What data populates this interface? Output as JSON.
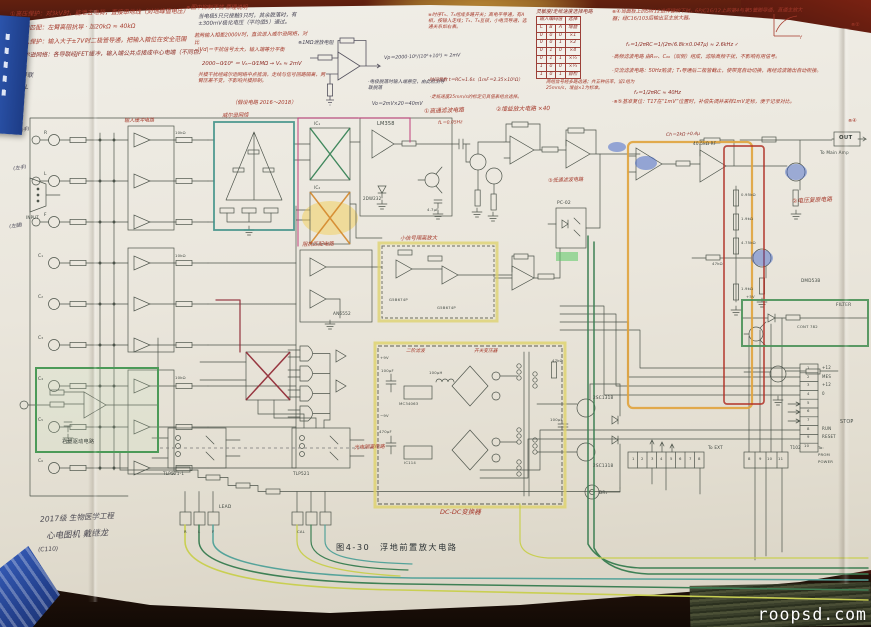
{
  "watermark": "roopsd.com",
  "caption": "图4-30　浮地前置放大电路",
  "bottom_note": {
    "l1": "2017级 生物医学工程",
    "l2": "心电图机  戴继龙",
    "l3": "(C110)"
  },
  "colors": {
    "highlight_teal": "#3f9188",
    "highlight_yellow": "#ded26a",
    "highlight_green": "#4c9a58",
    "highlight_orange": "#e0a33c",
    "highlight_crimson": "#b03127",
    "ink_red": "#a63a2c",
    "wire_green": "#3e8055",
    "wire_yellow": "#c9cf52",
    "wire_teal": "#55a39a",
    "wire_magenta": "#c2447e"
  },
  "truth_table": {
    "title": "灵敏度/走纸速度选择电路",
    "group": [
      "输入编码值",
      "选择"
    ],
    "cols": [
      "C",
      "B",
      "A",
      "增益"
    ],
    "rows": [
      [
        "0",
        "0",
        "0",
        "×1"
      ],
      [
        "0",
        "0",
        "1",
        "×2"
      ],
      [
        "0",
        "1",
        "0",
        "×4"
      ],
      [
        "0",
        "1",
        "1",
        "×½"
      ],
      [
        "1",
        "0",
        "0",
        "×¼"
      ],
      [
        "1",
        "0",
        "1",
        "自检"
      ]
    ]
  },
  "annotations": [
    {
      "t": "①高压保护：对3kV时，能泄去电荷，直接串地线（对地峰值电压）",
      "x": 10,
      "y": 11,
      "c": "red",
      "s": 6,
      "r": -1
    },
    {
      "t": "②高频匹配：左臂高阻抗导 · 加20kΩ ≈ 40kΩ",
      "x": 12,
      "y": 25,
      "c": "red",
      "s": 6,
      "r": -1
    },
    {
      "t": "③输入保护：输入大于±7V时二极管导通，把输入箝位在安全范围",
      "x": 12,
      "y": 39,
      "c": "red",
      "s": 6,
      "r": -1
    },
    {
      "t": "④威尔逊网络：各导联经JFET缓冲，输入端公共点接成中心电端（不同色）",
      "x": 13,
      "y": 53,
      "c": "dred",
      "s": 5.8,
      "r": -1
    },
    {
      "t": "⑤ 3导联",
      "x": 10,
      "y": 72,
      "c": "ink",
      "s": 6
    },
    {
      "t": "⑥ aVL",
      "x": 10,
      "y": 84,
      "c": "ink",
      "s": 6
    },
    {
      "t": "⑦ V₁",
      "x": 10,
      "y": 96,
      "c": "ink",
      "s": 6
    },
    {
      "t": "⑧ V₆",
      "x": 10,
      "y": 107,
      "c": "ink",
      "s": 6
    },
    {
      "t": "※图中抑制干扰 原理说明",
      "x": 186,
      "y": 5,
      "c": "red",
      "s": 5.5
    },
    {
      "t": "当电极5只只接触3只时，其余脱落时，有±300mV极化电压（平均值5）通过。",
      "x": 198,
      "y": 14,
      "c": "ink",
      "s": 5.4,
      "w": 118,
      "r": -1
    },
    {
      "t": "※1MΩ泄放电阻",
      "x": 298,
      "y": 40,
      "c": "ink",
      "s": 5
    },
    {
      "t": "Vp＝2000·10⁶/(10⁶+10⁹) ≈ 2mV",
      "x": 384,
      "y": 56,
      "c": "ink",
      "s": 4.8,
      "r": -2
    },
    {
      "t": "·电极脱落时输入端悬空，由此检测导联脱落",
      "x": 368,
      "y": 80,
      "c": "ink",
      "s": 4.7,
      "w": 80
    },
    {
      "t": "Vo＝2mV×20＝40mV",
      "x": 372,
      "y": 102,
      "c": "ink",
      "s": 4.8
    },
    {
      "t": "若两输入相差2000V时，直流进入威尔逊网络，对比",
      "x": 194,
      "y": 33,
      "c": "red",
      "s": 5.1,
      "w": 116,
      "r": -1
    },
    {
      "t": "|Vd|＝干扰信号太大，输入端等分平衡",
      "x": 198,
      "y": 47,
      "c": "red",
      "s": 5.1,
      "w": 112
    },
    {
      "t": "2000−0⁄10⁶ ＝ V₆−0⁄1MΩ → V₆ ≈ 2mV",
      "x": 202,
      "y": 61,
      "c": "dred",
      "s": 5.3
    },
    {
      "t": "共模干扰经威尔逊网络中点抵消，走线与信号回路隔离，两臂压差不变，不影响共模抑制。",
      "x": 198,
      "y": 72,
      "c": "red",
      "s": 4.9,
      "w": 128
    },
    {
      "t": "（假设电路 2016～2018）",
      "x": 232,
      "y": 100,
      "c": "red",
      "s": 5.2
    },
    {
      "t": "※时序T₅、T₆组成多路开关；高电平导通，有A相，按输入走线；T₅、T₆互锁，小电流导通，选通关系如右表。",
      "x": 428,
      "y": 13,
      "c": "red",
      "s": 4.7,
      "w": 100
    },
    {
      "t": "·时间常数 t＝RC≈1.6s（1mF＝2.35×10⁵Ω）",
      "x": 428,
      "y": 78,
      "c": "dred",
      "s": 4.5,
      "w": 110
    },
    {
      "t": "·走纸速度25mm/s的标定见真值表组合选择。",
      "x": 430,
      "y": 95,
      "c": "red",
      "s": 4.5,
      "w": 110
    },
    {
      "t": "两组信号经多路选通；共五种倍率，设1组为25mm/s，增益×1为标准。",
      "x": 546,
      "y": 80,
      "c": "red",
      "s": 4.5,
      "w": 94
    },
    {
      "t": "※④当面板上的SW12选择键按下时，6P/C16/12上的第4与第5管脚导通，直通主放大器；经C16/103后输出至主放大器。",
      "x": 612,
      "y": 9,
      "c": "red",
      "s": 5,
      "w": 200,
      "r": -0.5
    },
    {
      "t": "f₁＝1/2πRC＝1/(2π√6.8k×0.047μ) ≈ 2.6kHz ✓",
      "x": 626,
      "y": 42,
      "c": "dred",
      "s": 5
    },
    {
      "t": "·高频滤波电路 由R₀₇、C₀₆（双侧）组成，滤除高频干扰，不影响有用信号。",
      "x": 612,
      "y": 54,
      "c": "red",
      "s": 5,
      "w": 206
    },
    {
      "t": "·交流滤波电路：50Hz陷波；T₁导通后二极管截止，使带宽自动切换，再经滤波输出自动衔接。",
      "x": 612,
      "y": 68,
      "c": "red",
      "s": 5,
      "w": 210
    },
    {
      "t": "f₂＝1/2πRC ≈ 40Hz",
      "x": 634,
      "y": 90,
      "c": "dred",
      "s": 5
    },
    {
      "t": "·※⑤基准复位：T17在“1mV”位置时，补偿失调并采样1mV定标，便于记录对比。",
      "x": 612,
      "y": 99,
      "c": "red",
      "s": 5,
      "w": 212
    },
    {
      "t": "f",
      "x": 800,
      "y": 36,
      "c": "red",
      "s": 4.5
    },
    {
      "t": "※②",
      "x": 851,
      "y": 22,
      "c": "red",
      "s": 5
    },
    {
      "t": "※④",
      "x": 848,
      "y": 118,
      "c": "red",
      "s": 5
    },
    {
      "t": "①高通滤波电路",
      "x": 424,
      "y": 109,
      "c": "red",
      "s": 5.8,
      "r": -2
    },
    {
      "t": "fL＝0.05Hz",
      "x": 438,
      "y": 121,
      "c": "red",
      "s": 4.5,
      "r": -2
    },
    {
      "t": "②增益放大电路 ×40",
      "x": 496,
      "y": 107,
      "c": "red",
      "s": 5.8,
      "r": -1
    },
    {
      "t": "③低通滤波电路",
      "x": 548,
      "y": 178,
      "c": "red",
      "s": 5.1,
      "r": -2
    },
    {
      "t": "阻抗匹配电路",
      "x": 302,
      "y": 242,
      "c": "red",
      "s": 5.3,
      "r": -1
    },
    {
      "t": "小信号隔离放大",
      "x": 400,
      "y": 236,
      "c": "red",
      "s": 5.3,
      "r": -1
    },
    {
      "t": "光电隔离电路",
      "x": 354,
      "y": 445,
      "c": "red",
      "s": 5.1,
      "r": -2
    },
    {
      "t": "DC-DC变换器",
      "x": 440,
      "y": 508,
      "c": "red",
      "s": 6.5
    },
    {
      "t": "二阶滤波",
      "x": 406,
      "y": 349,
      "c": "red",
      "s": 4.7
    },
    {
      "t": "开关变压器",
      "x": 474,
      "y": 349,
      "c": "red",
      "s": 4.7
    },
    {
      "t": "②电压复原电路",
      "x": 792,
      "y": 199,
      "c": "red",
      "s": 5.8,
      "r": -3
    },
    {
      "t": "Ch＝2kΩ＋0.4μ",
      "x": 666,
      "y": 133,
      "c": "dred",
      "s": 4.5,
      "r": -2
    },
    {
      "t": "威尔逊网络",
      "x": 222,
      "y": 113,
      "c": "red",
      "s": 5.3,
      "r": -1
    },
    {
      "t": "输入缓冲电路",
      "x": 124,
      "y": 118,
      "c": "red",
      "s": 5,
      "r": -1
    },
    {
      "t": "(右手)",
      "x": 16,
      "y": 129,
      "c": "ink",
      "s": 4.8,
      "r": -8
    },
    {
      "t": "(左手)",
      "x": 13,
      "y": 167,
      "c": "ink",
      "s": 4.8,
      "r": -8
    },
    {
      "t": "(左腿)",
      "x": 9,
      "y": 225,
      "c": "ink",
      "s": 4.8,
      "r": -8
    },
    {
      "t": "R",
      "x": 44,
      "y": 131,
      "c": "prt",
      "s": 4.4
    },
    {
      "t": "L",
      "x": 44,
      "y": 172,
      "c": "prt",
      "s": 4.4
    },
    {
      "t": "F",
      "x": 44,
      "y": 213,
      "c": "prt",
      "s": 4.4
    },
    {
      "t": "C₁",
      "x": 38,
      "y": 254,
      "c": "prt",
      "s": 4.4
    },
    {
      "t": "C₂",
      "x": 38,
      "y": 295,
      "c": "prt",
      "s": 4.4
    },
    {
      "t": "C₃",
      "x": 38,
      "y": 336,
      "c": "prt",
      "s": 4.4
    },
    {
      "t": "C₄",
      "x": 38,
      "y": 377,
      "c": "prt",
      "s": 4.4
    },
    {
      "t": "C₅",
      "x": 38,
      "y": 418,
      "c": "prt",
      "s": 4.4
    },
    {
      "t": "C₆",
      "x": 38,
      "y": 459,
      "c": "prt",
      "s": 4.4
    },
    {
      "t": "INPUT",
      "x": 26,
      "y": 215,
      "c": "prt",
      "s": 4
    },
    {
      "t": "10kΩ",
      "x": 175,
      "y": 130,
      "c": "prt",
      "s": 3.8
    },
    {
      "t": "10kΩ",
      "x": 175,
      "y": 253,
      "c": "prt",
      "s": 3.8
    },
    {
      "t": "10kΩ",
      "x": 175,
      "y": 375,
      "c": "prt",
      "s": 3.8
    },
    {
      "t": "IC₁",
      "x": 314,
      "y": 121,
      "c": "prt",
      "s": 4.2
    },
    {
      "t": "IC₂",
      "x": 314,
      "y": 185,
      "c": "prt",
      "s": 4.2
    },
    {
      "t": "LM358",
      "x": 377,
      "y": 121,
      "c": "prt",
      "s": 5
    },
    {
      "t": "2DW232",
      "x": 363,
      "y": 196,
      "c": "prt",
      "s": 4
    },
    {
      "t": "4.7μF",
      "x": 427,
      "y": 207,
      "c": "prt",
      "s": 3.8
    },
    {
      "t": "AN6552",
      "x": 333,
      "y": 311,
      "c": "prt",
      "s": 4.2
    },
    {
      "t": "G5B674P",
      "x": 389,
      "y": 297,
      "c": "prt",
      "s": 3.8
    },
    {
      "t": "G5B674P",
      "x": 437,
      "y": 305,
      "c": "prt",
      "s": 3.8
    },
    {
      "t": "PC-02",
      "x": 557,
      "y": 201,
      "c": "prt",
      "s": 4.4
    },
    {
      "t": "40.5kΩ RF",
      "x": 693,
      "y": 141,
      "c": "prt",
      "s": 4.2
    },
    {
      "t": "0.95kΩ",
      "x": 741,
      "y": 192,
      "c": "prt",
      "s": 3.8
    },
    {
      "t": "1.9kΩ",
      "x": 741,
      "y": 216,
      "c": "prt",
      "s": 3.8
    },
    {
      "t": "4.75kΩ",
      "x": 741,
      "y": 240,
      "c": "prt",
      "s": 3.8
    },
    {
      "t": "1.9kΩ",
      "x": 741,
      "y": 286,
      "c": "prt",
      "s": 3.8
    },
    {
      "t": "OUT",
      "x": 839,
      "y": 135,
      "c": "prtb",
      "s": 5.4
    },
    {
      "t": "To Main Amp",
      "x": 820,
      "y": 150,
      "c": "prt",
      "s": 4.2
    },
    {
      "t": "DMD53B",
      "x": 801,
      "y": 278,
      "c": "prt",
      "s": 4.2
    },
    {
      "t": "47kΩ",
      "x": 712,
      "y": 261,
      "c": "prt",
      "s": 3.8
    },
    {
      "t": "FILTER",
      "x": 836,
      "y": 303,
      "c": "prt",
      "s": 4.4
    },
    {
      "t": "CONT 782",
      "x": 797,
      "y": 324,
      "c": "prt",
      "s": 3.8
    },
    {
      "t": "+5V",
      "x": 746,
      "y": 294,
      "c": "prt",
      "s": 3.8
    },
    {
      "t": "1",
      "x": 807,
      "y": 365,
      "c": "prt",
      "s": 3.8
    },
    {
      "t": "2",
      "x": 807,
      "y": 374,
      "c": "prt",
      "s": 3.8
    },
    {
      "t": "3",
      "x": 807,
      "y": 382,
      "c": "prt",
      "s": 3.8
    },
    {
      "t": "4",
      "x": 807,
      "y": 391,
      "c": "prt",
      "s": 3.8
    },
    {
      "t": "5",
      "x": 807,
      "y": 400,
      "c": "prt",
      "s": 3.8
    },
    {
      "t": "6",
      "x": 807,
      "y": 408,
      "c": "prt",
      "s": 3.8
    },
    {
      "t": "7",
      "x": 807,
      "y": 417,
      "c": "prt",
      "s": 3.8
    },
    {
      "t": "8",
      "x": 807,
      "y": 426,
      "c": "prt",
      "s": 3.8
    },
    {
      "t": "9",
      "x": 807,
      "y": 434,
      "c": "prt",
      "s": 3.8
    },
    {
      "t": "10",
      "x": 804,
      "y": 443,
      "c": "prt",
      "s": 3.8
    },
    {
      "t": "+12",
      "x": 822,
      "y": 365,
      "c": "prt",
      "s": 4
    },
    {
      "t": "MES",
      "x": 822,
      "y": 374,
      "c": "prt",
      "s": 4
    },
    {
      "t": "+12",
      "x": 822,
      "y": 382,
      "c": "prt",
      "s": 4
    },
    {
      "t": "0",
      "x": 822,
      "y": 391,
      "c": "prt",
      "s": 4
    },
    {
      "t": "RUN",
      "x": 822,
      "y": 426,
      "c": "prt",
      "s": 4
    },
    {
      "t": "RESET",
      "x": 822,
      "y": 434,
      "c": "prt",
      "s": 4
    },
    {
      "t": "STOP",
      "x": 840,
      "y": 420,
      "c": "prt",
      "s": 4.8
    },
    {
      "t": "To:",
      "x": 818,
      "y": 445,
      "c": "prt",
      "s": 3.8
    },
    {
      "t": "PROM",
      "x": 818,
      "y": 452,
      "c": "prt",
      "s": 3.8
    },
    {
      "t": "POWER",
      "x": 818,
      "y": 459,
      "c": "prt",
      "s": 3.8
    },
    {
      "t": "1",
      "x": 632,
      "y": 456,
      "c": "prt",
      "s": 3.8
    },
    {
      "t": "2",
      "x": 641,
      "y": 456,
      "c": "prt",
      "s": 3.8
    },
    {
      "t": "3",
      "x": 651,
      "y": 456,
      "c": "prt",
      "s": 3.8
    },
    {
      "t": "4",
      "x": 660,
      "y": 456,
      "c": "prt",
      "s": 3.8
    },
    {
      "t": "5",
      "x": 670,
      "y": 456,
      "c": "prt",
      "s": 3.8
    },
    {
      "t": "6",
      "x": 679,
      "y": 456,
      "c": "prt",
      "s": 3.8
    },
    {
      "t": "7",
      "x": 689,
      "y": 456,
      "c": "prt",
      "s": 3.8
    },
    {
      "t": "8",
      "x": 698,
      "y": 456,
      "c": "prt",
      "s": 3.8
    },
    {
      "t": "8",
      "x": 748,
      "y": 456,
      "c": "prt",
      "s": 3.8
    },
    {
      "t": "9",
      "x": 759,
      "y": 456,
      "c": "prt",
      "s": 3.8
    },
    {
      "t": "10",
      "x": 767,
      "y": 456,
      "c": "prt",
      "s": 3.8
    },
    {
      "t": "11",
      "x": 778,
      "y": 456,
      "c": "prt",
      "s": 3.8
    },
    {
      "t": "To EXT",
      "x": 708,
      "y": 445,
      "c": "prt",
      "s": 4.2
    },
    {
      "t": "T102",
      "x": 790,
      "y": 445,
      "c": "prt",
      "s": 4
    },
    {
      "t": "2SC1318",
      "x": 593,
      "y": 395,
      "c": "prt",
      "s": 4.2
    },
    {
      "t": "2SC1318",
      "x": 593,
      "y": 463,
      "c": "prt",
      "s": 4.2
    },
    {
      "t": "47kΩ",
      "x": 552,
      "y": 358,
      "c": "prt",
      "s": 3.8
    },
    {
      "t": "100μF",
      "x": 550,
      "y": 417,
      "c": "prt",
      "s": 3.8
    },
    {
      "t": "MC34063",
      "x": 399,
      "y": 401,
      "c": "prt",
      "s": 3.8
    },
    {
      "t": "IC114",
      "x": 404,
      "y": 460,
      "c": "prt",
      "s": 3.8
    },
    {
      "t": "100μH",
      "x": 429,
      "y": 370,
      "c": "prt",
      "s": 3.8
    },
    {
      "t": "100μF",
      "x": 381,
      "y": 368,
      "c": "prt",
      "s": 3.8
    },
    {
      "t": "470μF",
      "x": 379,
      "y": 429,
      "c": "prt",
      "s": 3.8
    },
    {
      "t": "DR₁",
      "x": 599,
      "y": 490,
      "c": "prt",
      "s": 4.2
    },
    {
      "t": "TLP521-1",
      "x": 163,
      "y": 471,
      "c": "prt",
      "s": 4.2
    },
    {
      "t": "TLP521",
      "x": 293,
      "y": 471,
      "c": "prt",
      "s": 4.2
    },
    {
      "t": "右腿驱动电路",
      "x": 62,
      "y": 439,
      "c": "prt",
      "s": 5.2
    },
    {
      "t": "LEAD",
      "x": 219,
      "y": 505,
      "c": "prt",
      "s": 4.4
    },
    {
      "t": "CAL",
      "x": 297,
      "y": 529,
      "c": "prt",
      "s": 3.8
    },
    {
      "t": "R",
      "x": 184,
      "y": 529,
      "c": "prt",
      "s": 3.8
    },
    {
      "t": "L",
      "x": 198,
      "y": 529,
      "c": "prt",
      "s": 3.8
    },
    {
      "t": "F",
      "x": 212,
      "y": 529,
      "c": "prt",
      "s": 3.8
    },
    {
      "t": "+9V",
      "x": 380,
      "y": 355,
      "c": "prt",
      "s": 3.8
    },
    {
      "t": "−9V",
      "x": 380,
      "y": 413,
      "c": "prt",
      "s": 3.8
    }
  ]
}
